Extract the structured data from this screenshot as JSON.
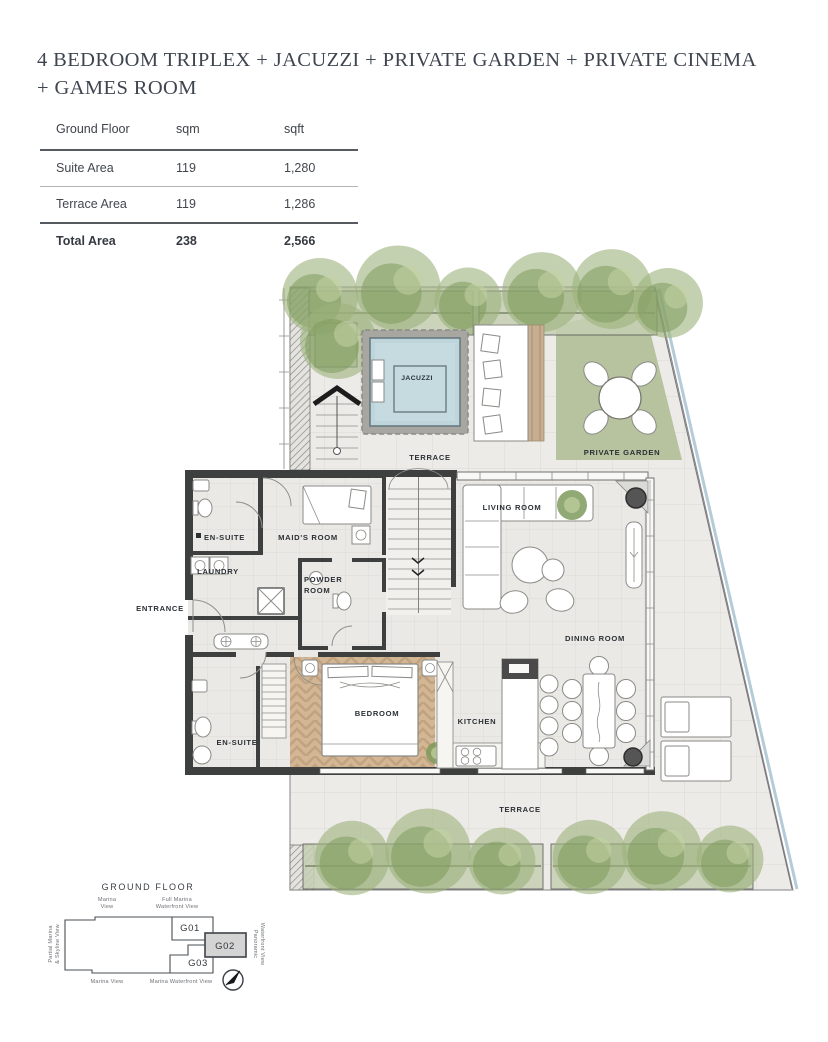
{
  "header": {
    "title_line1": "4 BEDROOM TRIPLEX + JACUZZI + PRIVATE GARDEN + PRIVATE CINEMA",
    "title_line2": "+ GAMES ROOM"
  },
  "area_table": {
    "columns": [
      "Ground Floor",
      "sqm",
      "sqft"
    ],
    "rows": [
      {
        "label": "Suite Area",
        "sqm": "119",
        "sqft": "1,280"
      },
      {
        "label": "Terrace Area",
        "sqm": "119",
        "sqft": "1,286"
      }
    ],
    "total": {
      "label": "Total Area",
      "sqm": "238",
      "sqft": "2,566"
    }
  },
  "floor_plan": {
    "labels": {
      "terrace_upper": "TERRACE",
      "jacuzzi": "JACUZZI",
      "private_garden": "PRIVATE GARDEN",
      "en_suite_top": "EN-SUITE",
      "maids_room": "MAID'S ROOM",
      "laundry": "LAUNDRY",
      "powder_line1": "POWDER",
      "powder_line2": "ROOM",
      "entrance": "ENTRANCE",
      "living_room": "LIVING ROOM",
      "dining_room": "DINING ROOM",
      "en_suite_bottom": "EN-SUITE",
      "bedroom": "BEDROOM",
      "kitchen": "KITCHEN",
      "terrace_lower": "TERRACE"
    }
  },
  "key_plan": {
    "title": "GROUND FLOOR",
    "views": {
      "top_left_1": "Marina",
      "top_left_2": "View",
      "top_right_1": "Full Marina",
      "top_right_2": "Waterfront View",
      "left_1": "Partial Marina",
      "left_2": "& Skyline View",
      "right_1": "Panoramic",
      "right_2": "Waterfront View",
      "bottom_left": "Marina View",
      "bottom_center": "Marina Waterfront View"
    },
    "units": [
      {
        "id": "G01"
      },
      {
        "id": "G02"
      },
      {
        "id": "G03"
      }
    ],
    "highlighted_unit": "G02"
  },
  "colors": {
    "ink": "#3f4550",
    "table-line-dark": "#565b61",
    "table-line-light": "#b3b6b9",
    "wall": "#3e3f3f",
    "floor-indoor": "#ebe9e5",
    "floor-terrace": "#edebe7",
    "wood": "#d3b694",
    "water": "#bdd5db",
    "stone": "#a7a6a1",
    "grass": "#b7c29e",
    "tree-dark": "#7e9a5c",
    "tree-light": "#9db37c",
    "glass": "#a9c4d2",
    "fixture": "#8a8a86",
    "label": "#2b3036",
    "key-line": "#4a4f54",
    "key-muted": "#6d7176",
    "highlight": "#d4d4d4"
  }
}
